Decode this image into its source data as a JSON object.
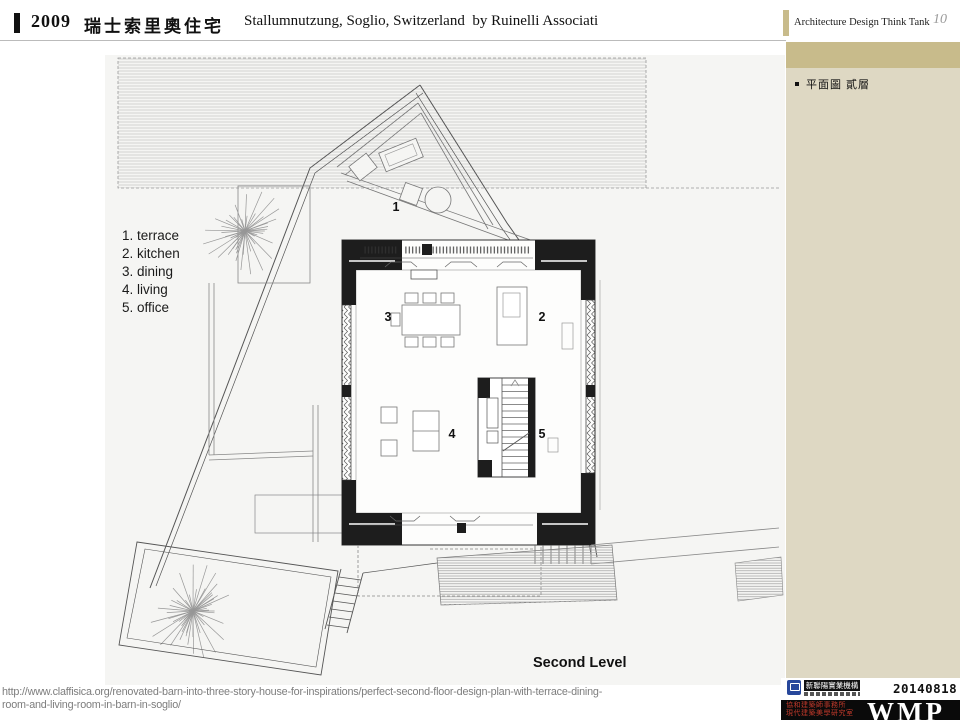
{
  "header": {
    "year": "2009",
    "title_zh": "瑞士索里奧住宅",
    "title_en": "Stallumnutzung, Soglio, Switzerland  by Ruinelli Associati",
    "brand": "Architecture Design Think Tank",
    "page_number": "10"
  },
  "sidebar": {
    "note": "平面圖 貳層"
  },
  "plan": {
    "legend": [
      "1. terrace",
      "2. kitchen",
      "3. dining",
      "4. living",
      "5. office"
    ],
    "rooms": {
      "r1": "1",
      "r2": "2",
      "r3": "3",
      "r4": "4",
      "r5": "5"
    },
    "level_label": "Second Level"
  },
  "footer": {
    "url_line1": "http://www.claffisica.org/renovated-barn-into-three-story-house-for-inspirations/perfect-second-floor-design-plan-with-terrace-dining-",
    "url_line2": "room-and-living-room-in-barn-in-soglio/",
    "logo_top_text": "新聯陽實業機構",
    "logo_red_line1": "協和建築師事務所",
    "logo_red_line2": "現代建築美學研究室",
    "date": "20140818",
    "wmp": "WMP"
  },
  "colors": {
    "tan_band": "#c8bb8b",
    "beige_panel": "#ded8c3",
    "plan_background": "#f5f5f3",
    "black_wall": "#1d1d1d",
    "url_gray": "#7d7d7d",
    "logo_blue": "#27479b",
    "logo_red": "#c0392b",
    "footer_black": "#0a0a0a"
  }
}
